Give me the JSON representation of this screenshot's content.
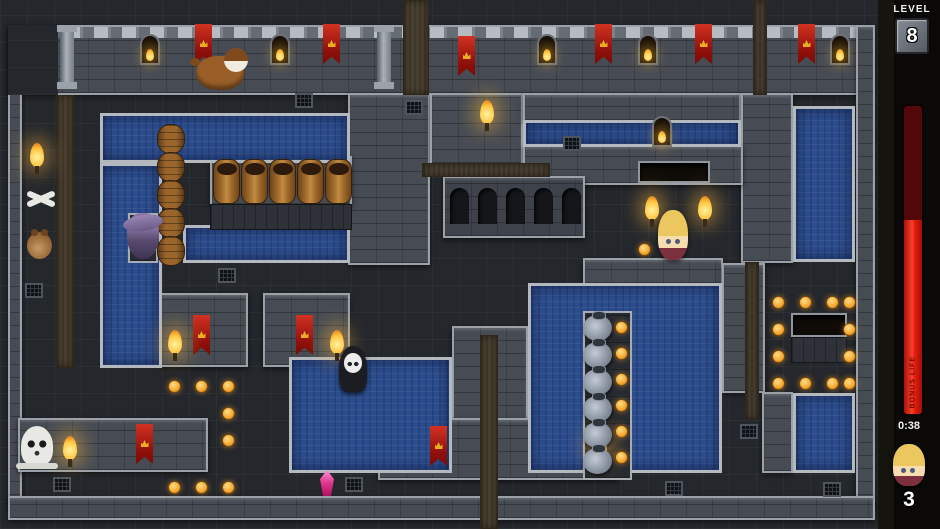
{
  "hud": {
    "level_label": "LEVEL",
    "level_value": "8",
    "bonus_bar_label": "BONUS LIFE",
    "bonus_fill_percent": 63,
    "timer": "0:38",
    "lives": "3",
    "colors": {
      "bar_fill": "#e81c0c",
      "bar_depleted": "#520708",
      "coin": "#f5a62e",
      "water": "#2c4d8d",
      "wall": "#474c54",
      "floor": "#24272c",
      "dirt": "#4a4030",
      "banner_red": "#b01510",
      "edge": "#9aa1a8"
    }
  },
  "map": {
    "width": 878,
    "height": 529,
    "walls": [
      [
        8,
        25,
        862,
        70,
        "band"
      ],
      [
        8,
        25,
        14,
        485
      ],
      [
        856,
        25,
        19,
        485
      ],
      [
        8,
        496,
        867,
        24
      ],
      [
        348,
        93,
        82,
        172
      ],
      [
        430,
        93,
        93,
        72
      ],
      [
        523,
        93,
        218,
        29
      ],
      [
        741,
        93,
        52,
        170
      ],
      [
        523,
        145,
        220,
        40
      ],
      [
        443,
        176,
        142,
        62,
        "colonnade"
      ],
      [
        583,
        258,
        140,
        27
      ],
      [
        722,
        263,
        43,
        130
      ],
      [
        452,
        326,
        76,
        147
      ],
      [
        160,
        293,
        88,
        74
      ],
      [
        263,
        293,
        87,
        74
      ],
      [
        18,
        418,
        190,
        54
      ],
      [
        378,
        418,
        242,
        62
      ],
      [
        762,
        392,
        31,
        81
      ],
      [
        210,
        156,
        142,
        50
      ]
    ],
    "floors": [
      [
        8,
        25,
        50,
        70
      ]
    ],
    "dirt": [
      [
        403,
        0,
        26,
        95
      ],
      [
        753,
        0,
        14,
        95
      ],
      [
        56,
        95,
        18,
        273
      ],
      [
        422,
        163,
        128,
        14
      ],
      [
        480,
        335,
        18,
        194
      ],
      [
        745,
        262,
        14,
        158
      ]
    ],
    "water": [
      [
        100,
        113,
        250,
        50
      ],
      [
        100,
        163,
        62,
        205
      ],
      [
        183,
        225,
        167,
        38
      ],
      [
        289,
        357,
        163,
        116
      ],
      [
        528,
        283,
        194,
        190
      ],
      [
        523,
        120,
        218,
        27
      ],
      [
        793,
        106,
        62,
        156
      ],
      [
        793,
        393,
        62,
        80
      ]
    ],
    "islands": [
      [
        583,
        311,
        49,
        169
      ],
      [
        128,
        213,
        30,
        50
      ]
    ],
    "ledges": [
      [
        210,
        204,
        142,
        26
      ],
      [
        791,
        337,
        56,
        26
      ]
    ],
    "pits": [
      [
        791,
        313,
        56,
        24
      ],
      [
        638,
        161,
        72,
        22
      ]
    ],
    "arches": [
      [
        450,
        188
      ],
      [
        478,
        188
      ],
      [
        506,
        188
      ],
      [
        534,
        188
      ],
      [
        562,
        188
      ]
    ],
    "pillars": [
      [
        60,
        25
      ],
      [
        377,
        25
      ]
    ],
    "grates": [
      [
        25,
        283
      ],
      [
        218,
        268
      ],
      [
        295,
        93
      ],
      [
        405,
        100
      ],
      [
        563,
        136
      ],
      [
        345,
        477
      ],
      [
        53,
        477
      ],
      [
        740,
        424
      ],
      [
        823,
        482
      ],
      [
        665,
        481
      ]
    ],
    "windows": [
      [
        140,
        34
      ],
      [
        270,
        34
      ],
      [
        537,
        34
      ],
      [
        638,
        34
      ],
      [
        830,
        34
      ],
      [
        652,
        116
      ]
    ],
    "banners": [
      [
        195,
        24
      ],
      [
        323,
        24
      ],
      [
        458,
        36
      ],
      [
        595,
        24
      ],
      [
        695,
        24
      ],
      [
        798,
        24
      ],
      [
        193,
        315
      ],
      [
        296,
        315
      ],
      [
        136,
        424
      ],
      [
        430,
        426
      ]
    ],
    "torches": [
      [
        30,
        143
      ],
      [
        480,
        100
      ],
      [
        63,
        436
      ],
      [
        593,
        433
      ],
      [
        168,
        330
      ],
      [
        330,
        330
      ],
      [
        645,
        196
      ],
      [
        698,
        196
      ]
    ],
    "vases": [
      [
        583,
        315
      ],
      [
        583,
        342
      ],
      [
        583,
        369
      ],
      [
        583,
        396
      ],
      [
        583,
        422
      ],
      [
        583,
        448
      ]
    ],
    "barrels_upright": [
      [
        213,
        159
      ],
      [
        241,
        159
      ],
      [
        269,
        159
      ],
      [
        297,
        159
      ],
      [
        325,
        159
      ]
    ],
    "barrels_side": [
      [
        157,
        124
      ],
      [
        157,
        152
      ],
      [
        157,
        180
      ],
      [
        157,
        208
      ],
      [
        157,
        236
      ]
    ],
    "coins": [
      [
        638,
        243
      ],
      [
        168,
        380
      ],
      [
        195,
        380
      ],
      [
        222,
        380
      ],
      [
        222,
        407
      ],
      [
        222,
        434
      ],
      [
        168,
        481
      ],
      [
        195,
        481
      ],
      [
        222,
        481
      ],
      [
        615,
        321
      ],
      [
        615,
        347
      ],
      [
        615,
        373
      ],
      [
        615,
        399
      ],
      [
        615,
        425
      ],
      [
        615,
        451
      ],
      [
        772,
        296
      ],
      [
        799,
        296
      ],
      [
        826,
        296
      ],
      [
        843,
        296
      ],
      [
        772,
        323
      ],
      [
        843,
        323
      ],
      [
        772,
        350
      ],
      [
        843,
        350
      ],
      [
        772,
        377
      ],
      [
        799,
        377
      ],
      [
        826,
        377
      ],
      [
        843,
        377
      ]
    ],
    "characters": [
      {
        "type": "dog",
        "x": 196,
        "y": 56
      },
      {
        "type": "hamster",
        "x": 27,
        "y": 232
      },
      {
        "type": "bones",
        "x": 24,
        "y": 186
      },
      {
        "type": "witch",
        "x": 127,
        "y": 213
      },
      {
        "type": "reaper",
        "x": 339,
        "y": 346
      },
      {
        "type": "skull",
        "x": 21,
        "y": 426
      },
      {
        "type": "player",
        "x": 658,
        "y": 210
      },
      {
        "type": "gem",
        "x": 320,
        "y": 470
      }
    ]
  }
}
